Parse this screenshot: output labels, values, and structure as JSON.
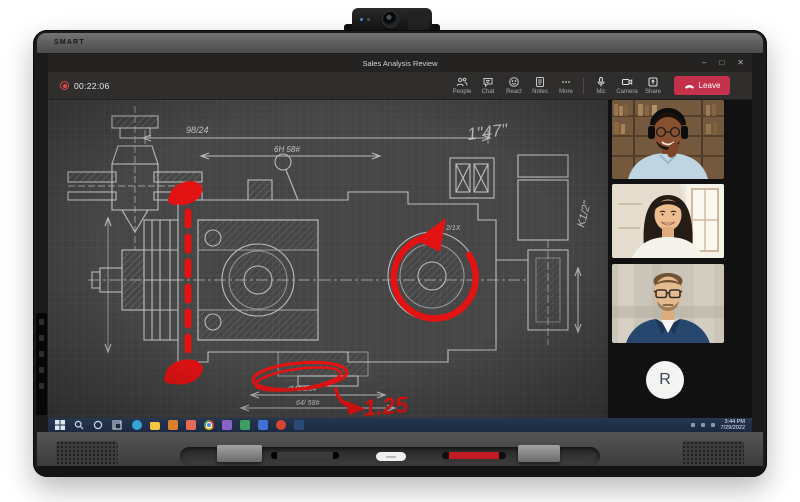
{
  "device": {
    "brand": "SMART",
    "hardware": {
      "home_button": "home",
      "pens": [
        "black-pen",
        "red-pen"
      ],
      "erasers": 2
    }
  },
  "window": {
    "title": "Sales Analysis Review",
    "controls": {
      "minimize": "–",
      "maximize": "□",
      "close": "✕"
    }
  },
  "meeting": {
    "recording_time": "00:22:06",
    "toolbar": [
      {
        "id": "people",
        "label": "People"
      },
      {
        "id": "chat",
        "label": "Chat"
      },
      {
        "id": "react",
        "label": "React"
      },
      {
        "id": "notes",
        "label": "Notes"
      },
      {
        "id": "more",
        "label": "More"
      }
    ],
    "av_controls": [
      {
        "id": "mic",
        "label": "Mic"
      },
      {
        "id": "camera",
        "label": "Camera"
      },
      {
        "id": "share",
        "label": "Share"
      }
    ],
    "leave_label": "Leave",
    "participants": [
      {
        "desc": "man with headset smiling, bookshelf background"
      },
      {
        "desc": "woman smiling, bright room with window"
      },
      {
        "desc": "man with glasses in navy suit, office background"
      }
    ],
    "avatar_initial": "R"
  },
  "blueprint": {
    "labels": {
      "dim_top": "98/24",
      "dim_mid": "6H 58#",
      "handwritten_top": "1\"47\"",
      "fitting": "K1/2\"",
      "dim_bottom": "Ø41 Ø94",
      "dim_bottom2": "64/ 58#",
      "dim_right": "2/1X"
    },
    "annotation_value": "1.25",
    "annotation_color": "#e41313"
  },
  "taskbar": {
    "time": "3:44 PM",
    "date": "7/29/2022",
    "system_icons": [
      "start-icon",
      "search-icon",
      "cortana-icon",
      "task-view-icon"
    ],
    "apps": [
      {
        "name": "edge",
        "shape": "circle",
        "color": "#35a3d8"
      },
      {
        "name": "file-explorer",
        "shape": "folder",
        "color": "#f5c542"
      },
      {
        "name": "app-orange",
        "shape": "square",
        "color": "#d9822b"
      },
      {
        "name": "app-coral",
        "shape": "square",
        "color": "#e56a54"
      },
      {
        "name": "chrome",
        "shape": "circle",
        "color": "conic"
      },
      {
        "name": "app-purple",
        "shape": "square",
        "color": "#8a63c9"
      },
      {
        "name": "app-green",
        "shape": "square",
        "color": "#3d9e5f"
      },
      {
        "name": "app-blue",
        "shape": "square",
        "color": "#3f6fd1"
      },
      {
        "name": "app-red",
        "shape": "circle",
        "color": "#d8452f"
      },
      {
        "name": "app-navy",
        "shape": "square",
        "color": "#2b4a77"
      }
    ]
  },
  "colors": {
    "leave_button": "#c4314b",
    "record_red": "#de4a4a",
    "taskbar_bg": "#1f2e48",
    "blueprint_bg": "#454545",
    "annotation_red": "#e41313"
  }
}
